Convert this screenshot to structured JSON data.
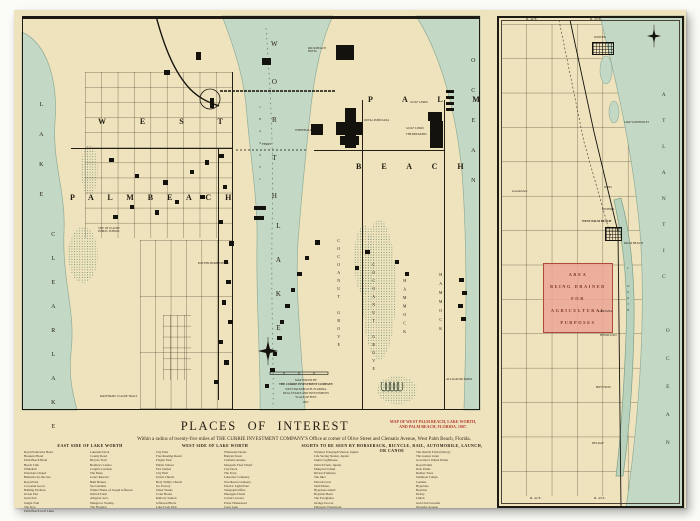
{
  "page": {
    "title": "PLACES  OF  INTEREST",
    "subtitle": "Within a radius of twenty-five miles of THE CURRIE INVESTMENT COMPANY'S Office at corner of Olive Street and Clematis Avenue, West Palm Beach, Florida.",
    "red_note_lines": [
      "MAP OF WEST PALM BEACH, LAKE WORTH,",
      "AND PALM BEACH, FLORIDA.   1907."
    ]
  },
  "colors": {
    "paper": "#efe3bd",
    "water": "#c4d8c6",
    "pink": "#eba99b",
    "red": "#b5372c",
    "ink": "#1d1a13"
  },
  "main_map": {
    "labels": {
      "lake_left_top": "L A K E",
      "clear_lake": "C L E A R   L A K E",
      "worth": "W O R T H",
      "lake_mid": "L A K E",
      "channel": "C H A N N E L",
      "west": "W E S T",
      "palm_beach_west": "P A L M     B E A C H",
      "palm": "P A L M",
      "beach": "B E A C H",
      "ocean": "O C E A N",
      "cocoanut_grove": "COCOANUT GROVE",
      "hammock": "HAMMOCK",
      "golf_links": "GOLF LINKS",
      "alligator_farm": "ALLIGATOR FARM",
      "potter_homestead": "POTTER HOMESTEAD",
      "public_school": "SITE OF 10 ACRE PUBLIC SCHOOL",
      "matthams": "MATTHAMS' 10 ACRE TRACT",
      "royal_poinciana": "ROYAL POINCIANA",
      "breakers": "THE BREAKERS",
      "whitehall": "WHITEHALL",
      "palm_beach_hotel": "PALM BEACH HOTEL",
      "ferry": "FERRY"
    },
    "publisher_lines": [
      "MAP ISSUED BY",
      "THE CURRIE INVESTMENT COMPANY",
      "WEST PALM BEACH, FLORIDA.",
      "REAL ESTATE AND INVESTMENTS",
      "SCALE OF FEET",
      "1907."
    ]
  },
  "inset_map": {
    "range_top_left": "R. 42 E.",
    "range_top_right": "R. 43 E.",
    "range_bottom_left": "R. 42 E.",
    "range_bottom_right": "R. 43 E.",
    "atlantic": "A T L A N T I C",
    "ocean": "O C E A N",
    "lake_worth": "L. WORTH",
    "drained_lines": [
      "AREA",
      "BEING DRAINED",
      "FOR",
      "AGRICULTURAL",
      "PURPOSES"
    ],
    "towns": {
      "jupiter": "JUPITER",
      "juno": "JUNO",
      "riviera": "RIVIERA",
      "west_palm_beach": "WEST PALM BEACH",
      "palm_beach": "PALM BEACH",
      "lantana": "LANTANA",
      "hypoluxo": "HYPOLUXO",
      "boynton": "BOYNTON",
      "delray": "DELRAY",
      "loxahatchee": "Loxahatchee",
      "inlet": "LAKE WORTH INLET"
    }
  },
  "lists": {
    "headers": {
      "east": "EAST SIDE OF LAKE WORTH",
      "west": "WEST SIDE OF LAKE WORTH",
      "sights": "SIGHTS TO BE SEEN BY HORSEBACK, BICYCLE, RAIL, AUTOMOBILE, LAUNCH, OR CANOE"
    },
    "col_a": [
      "Royal Poinciana Hotel",
      "Breakers Hotel",
      "Palm Beach Hotel",
      "Beach Club",
      "Whitehall",
      "Poinciana Chapel",
      "Bethesda-by-the-Sea",
      "Royal Park",
      "Cocoanut Grove",
      "Bathing Pavilion",
      "Ocean Pier",
      "Gun Club",
      "Jungle Trail",
      "The Styx",
      "Palm Beach Golf Links"
    ],
    "col_b": [
      "Lakeside Dock",
      "County Road",
      "Bicycle Trail",
      "Bradley's Casino",
      "Cragin's Gardens",
      "The Maze",
      "Gale's Reserve",
      "Bath Houses",
      "Sea Gardens",
      "Winter Home of Joseph Jefferson",
      "Ostrich Farm",
      "Alligator Joe's",
      "Mangrove Swamp",
      "The Hospital"
    ],
    "col_c": [
      "City Park",
      "Free Reading Room",
      "Flagler Park",
      "Public School",
      "Fire Station",
      "City Hall",
      "Union Church",
      "Holy Trinity Church",
      "Ice Factory",
      "Water Works",
      "Court House",
      "Railway Station",
      "Jefferson Block",
      "Lake Front Park"
    ],
    "col_d": [
      "Wholesale Docks",
      "Banyan Street",
      "Clematis Avenue",
      "Mosquito Fleet Wharf",
      "City Dock",
      "The Ferry",
      "Lakeview Cemetery",
      "Woodlawn Cemetery",
      "Electric Light Plant",
      "Telegraph Office",
      "Pineapple Fields",
      "Currie's Groves",
      "Potter Homestead",
      "Clear Lake"
    ],
    "col_e": [
      "Wireless Telegraph Station, Jupiter",
      "Life Saving Station, Jupiter",
      "Jupiter Lighthouse",
      "Ostrich Farm, Jupiter",
      "Munyon's Island",
      "Riviera Fisheries",
      "The Inlet",
      "Pelican Crest",
      "Sand Dunes",
      "Hypoluxo Island",
      "Boynton Hotel",
      "The Everglades",
      "Orange Groves",
      "Pineapple Plantations"
    ],
    "col_f": [
      "The Ostrich Farm (Delray)",
      "The Gomez Grant",
      "Governor's Winter Home",
      "Royal Palms",
      "Date Palms",
      "Rubber Trees",
      "Seminole Camps",
      "Lantana",
      "Hypoluxo",
      "Boynton",
      "Delray",
      "Linton",
      "Gun Club Grounds",
      "Oleander Avenue"
    ]
  }
}
